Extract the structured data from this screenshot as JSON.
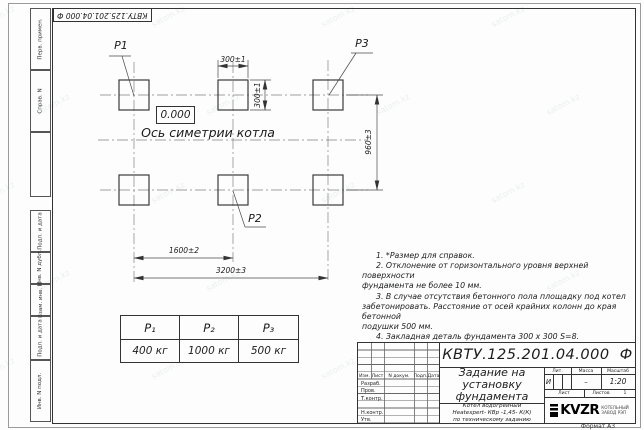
{
  "watermark": {
    "text": "satom.kz"
  },
  "frame": {
    "doc_number_top": "КВТУ.125.201.04.000  Ф",
    "left_strip_top": [
      "Перв. примен.",
      "Справ. N"
    ],
    "left_strip_bottom": [
      "Подп. и дата",
      "Инв. N дубл.",
      "Взам. инв. N",
      "Подп. и дата",
      "Инв. N подл."
    ],
    "format_note": "Формат А3"
  },
  "drawing": {
    "pad_labels": {
      "p1": "P1",
      "p2": "P2",
      "p3": "P3"
    },
    "elevation_mark": "0.000",
    "axis_label": "Ось симетрии котла",
    "dimensions": {
      "pad_width": "300±1",
      "pad_height": "300±1",
      "row_spacing": "960±3",
      "col_spacing": "1600±2",
      "total_width": "3200±3"
    }
  },
  "notes": [
    "1.  *Размер для справок.",
    "2.  Отклонение от горизонтального уровня верхней поверхности\nфундамента не более 10 мм.",
    "3.  В случае отсутствия бетонного пола площадку под котел\nзабетонировать. Расстояние от осей крайних колонн до края бетонной\nподушки 500 мм.",
    "4.  Закладная деталь фундамента  300 x 300 S=8.",
    "5.  Фундамент под котел разрабатывает проектная организация\nпо нагрузкам на фундамент."
  ],
  "load_table": {
    "headers": [
      "P₁",
      "P₂",
      "P₃"
    ],
    "values": [
      "400 кг",
      "1000 кг",
      "500 кг"
    ]
  },
  "title_block": {
    "doc_number": "КВТУ.125.201.04.000  Ф",
    "title": "Задание на\nустановку\nфундамента",
    "product": "Котел водогрейный\nHeatexpert- КВр -1,45- К(К)\nпо техническому заданию",
    "rev_headers": [
      "Изм.",
      "Лист",
      "N докум.",
      "Подп.",
      "Дата"
    ],
    "roles": [
      "Разраб.",
      "Пров.",
      "Т.контр.",
      "Н.контр.",
      "Утв."
    ],
    "lit_label": "Лит.",
    "mass_label": "Масса",
    "scale_label": "Масштаб",
    "lit_value": "И",
    "mass_value": "–",
    "scale_value": "1:20",
    "sheet_label": "Лист",
    "sheets_label": "Листов",
    "sheets_value": "1",
    "logo_text": "KVZR",
    "logo_caption": "КОТЕЛЬНЫЙ\nЗАВОД РЭП"
  }
}
